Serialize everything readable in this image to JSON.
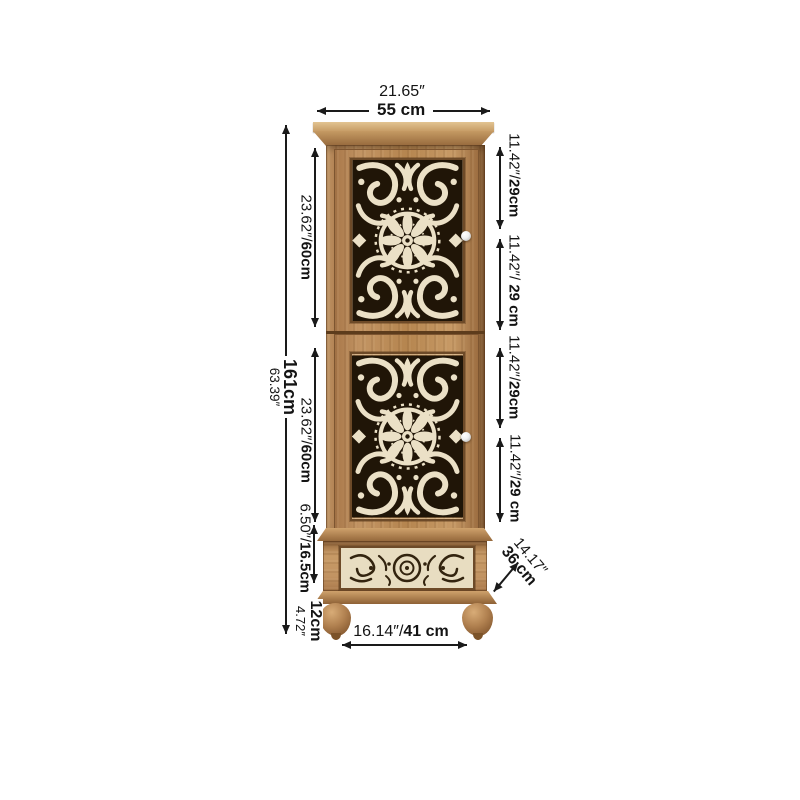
{
  "figure": {
    "type": "product-dimension-diagram",
    "subject": "Carved two-door wooden cabinet with lower drawer and bun feet"
  },
  "colors": {
    "background": "#ffffff",
    "annotation_text": "#1a1a1a",
    "dimension_line": "#1a1a1a",
    "wood_mid": "#b5854f",
    "wood_light": "#dfc08d",
    "wood_dark": "#7a5130",
    "carving_cream": "#ebe0c6",
    "carving_shadow": "#201507",
    "drawer_panel_cream": "#e8ddc1",
    "knob_white": "#f2f2f2"
  },
  "annotations": {
    "top_width": {
      "inches": "21.65″",
      "metric": "55 cm"
    },
    "overall_height": {
      "metric": "161cm",
      "inches": "63.39″"
    },
    "upper_door_height": {
      "inches": "23.62″/",
      "metric": "60cm"
    },
    "lower_door_height": {
      "inches": "23.62″/",
      "metric": "60cm"
    },
    "drawer_height": {
      "inches": "6.50″/",
      "metric": "16.5cm"
    },
    "leg_height": {
      "metric": "12cm",
      "inches": "4.72″"
    },
    "right_segments": [
      {
        "inches": "11.42″/",
        "metric": "29cm"
      },
      {
        "inches": "11.42″/ ",
        "metric": "29 cm"
      },
      {
        "inches": "11.42″/",
        "metric": "29cm"
      },
      {
        "inches": "11.42″/",
        "metric": "29 cm"
      }
    ],
    "bottom_width": {
      "inches": "16.14″/",
      "metric": "41 cm"
    },
    "depth": {
      "inches": "14.17″",
      "metric": "36 cm"
    }
  }
}
